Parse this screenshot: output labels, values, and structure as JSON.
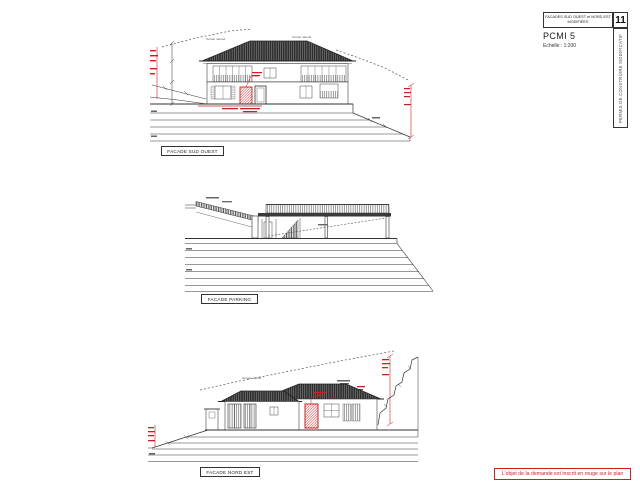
{
  "sheet": {
    "title_block": {
      "title_line1": "FACADES SUD OUEST et NORD EST",
      "title_line2": "MODIFIÉES",
      "sheet_number": "11",
      "piece_code": "PCMI 5",
      "scale": "Echelle : 1:200",
      "side_text": "PERMIS DE CONSTRUIRE MODIFICATIF"
    },
    "red_note": "L'objet de la demande est inscrit en rouge sur le plan"
  },
  "facades": {
    "sud_ouest": {
      "label": "FACADE SUD OUEST"
    },
    "parking": {
      "label": "FACADE PARKING"
    },
    "nord_est": {
      "label": "FACADE NORD EST"
    }
  },
  "annotations": {
    "terrain_label": "Terrain naturel"
  },
  "colors": {
    "ink": "#333333",
    "red": "#cc1f1f",
    "muted": "#666666"
  }
}
